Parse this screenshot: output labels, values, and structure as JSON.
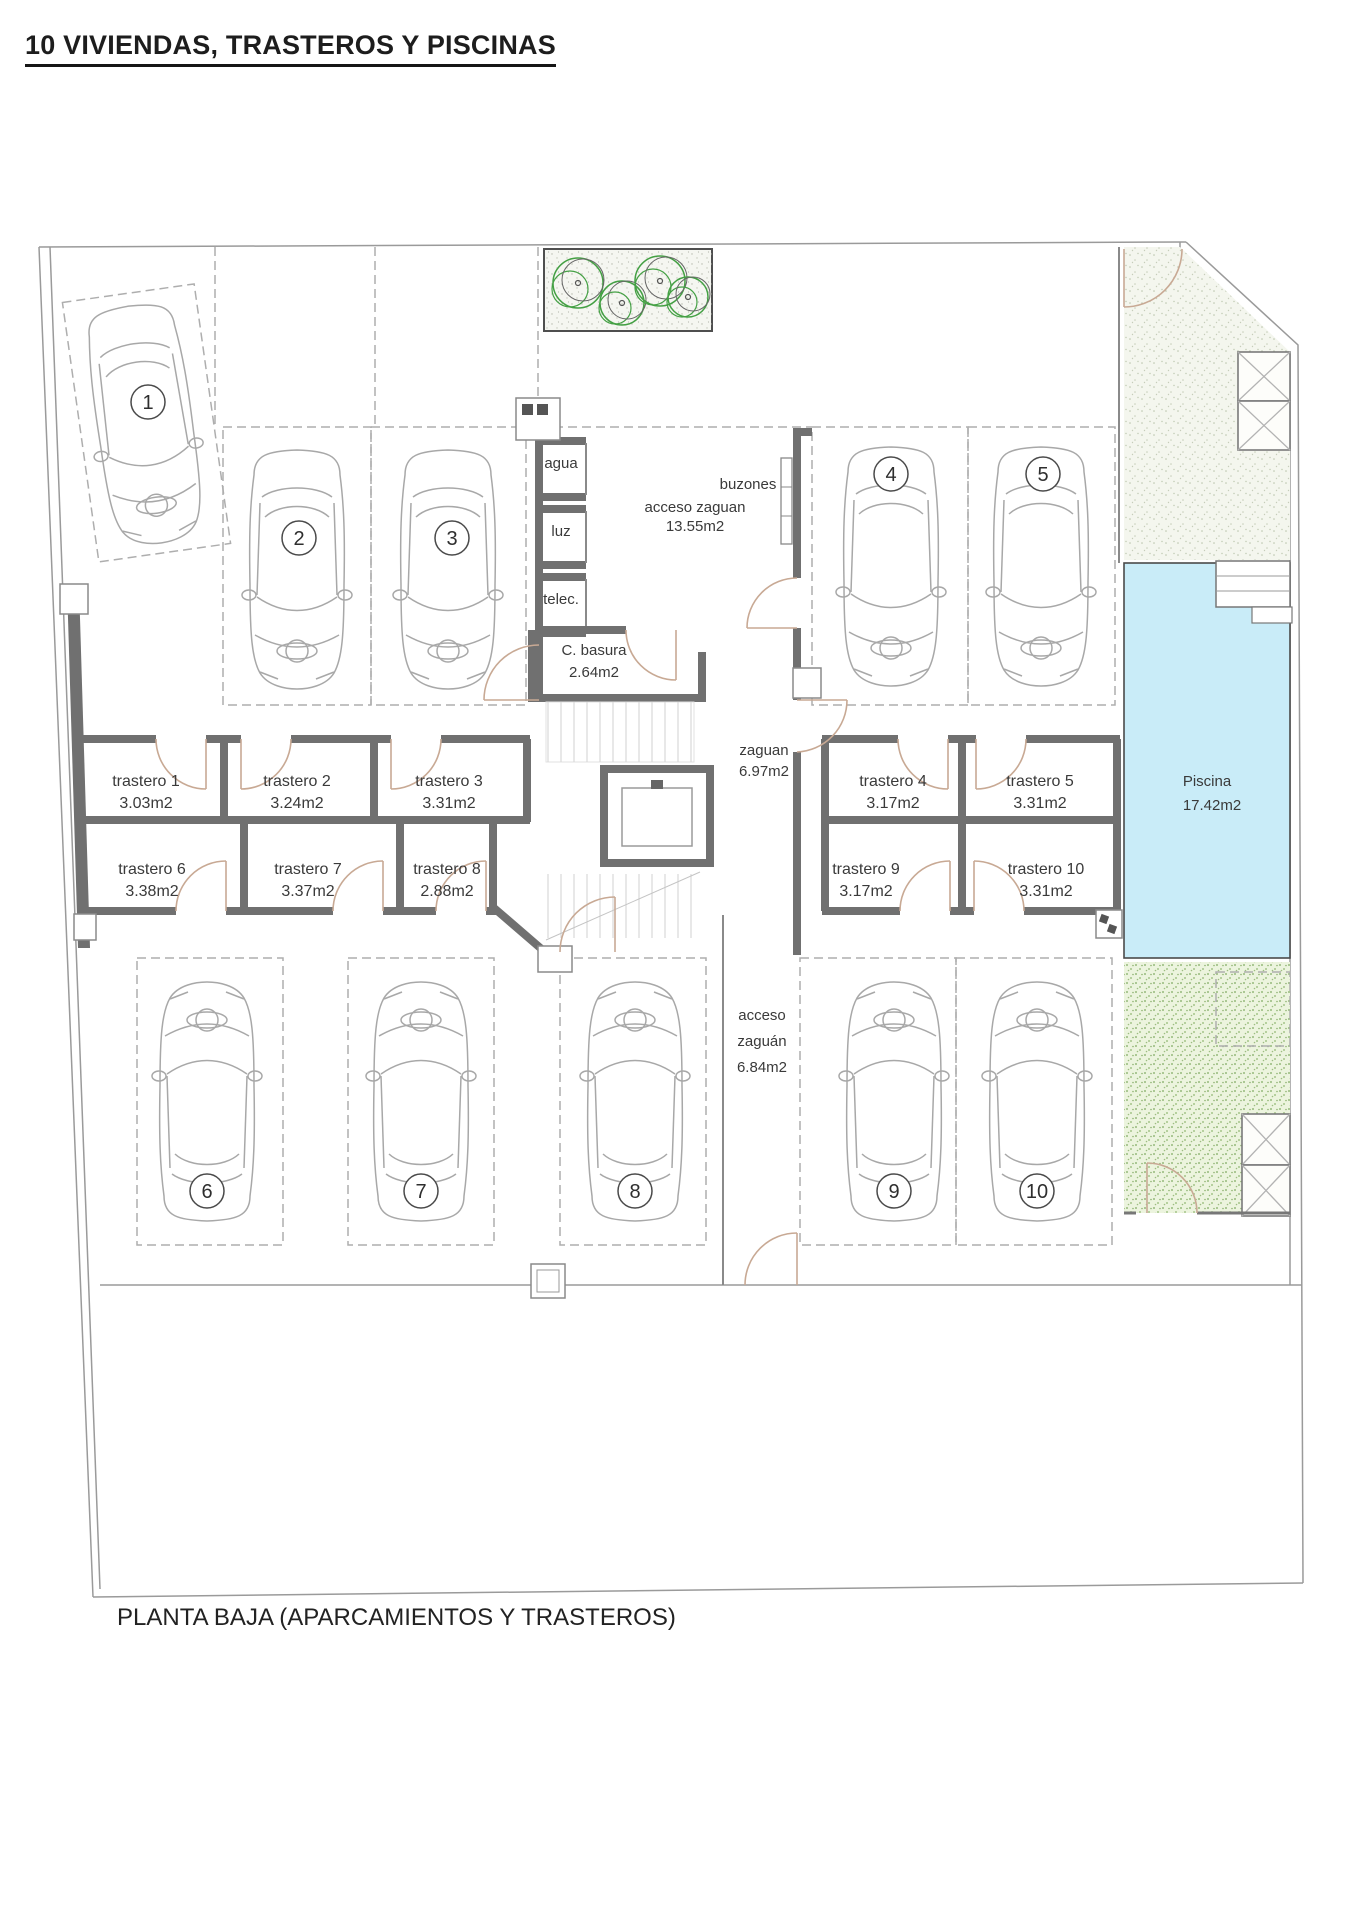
{
  "title": "10 VIVIENDAS, TRASTEROS Y PISCINAS",
  "caption": "PLANTA BAJA (APARCAMIENTOS Y TRASTEROS)",
  "parking_numbers": [
    "1",
    "2",
    "3",
    "4",
    "5",
    "6",
    "7",
    "8",
    "9",
    "10"
  ],
  "trasteros": [
    {
      "name": "trastero 1",
      "area": "3.03m2"
    },
    {
      "name": "trastero 2",
      "area": "3.24m2"
    },
    {
      "name": "trastero 3",
      "area": "3.31m2"
    },
    {
      "name": "trastero 4",
      "area": "3.17m2"
    },
    {
      "name": "trastero 5",
      "area": "3.31m2"
    },
    {
      "name": "trastero 6",
      "area": "3.38m2"
    },
    {
      "name": "trastero 7",
      "area": "3.37m2"
    },
    {
      "name": "trastero 8",
      "area": "2.88m2"
    },
    {
      "name": "trastero 9",
      "area": "3.17m2"
    },
    {
      "name": "trastero 10",
      "area": "3.31m2"
    }
  ],
  "utilities": {
    "agua": "agua",
    "luz": "luz",
    "telec": "telec."
  },
  "rooms": {
    "acceso_zaguan": {
      "name": "acceso zaguan",
      "area": "13.55m2"
    },
    "buzones": "buzones",
    "c_basura": {
      "name": "C. basura",
      "area": "2.64m2"
    },
    "zaguan": {
      "name": "zaguan",
      "area": "6.97m2"
    },
    "acceso_zaguan_sur": {
      "line1": "acceso",
      "line2": "zaguán",
      "line3": "6.84m2"
    },
    "piscina": {
      "name": "Piscina",
      "area": "17.42m2"
    }
  },
  "colors": {
    "wall": "#707070",
    "pool_fill": "#c9ecf8",
    "door": "#c8a994",
    "tree_green": "#44a044",
    "garden_light": "#f4f6ee",
    "garden_green": "#ecf4de"
  }
}
